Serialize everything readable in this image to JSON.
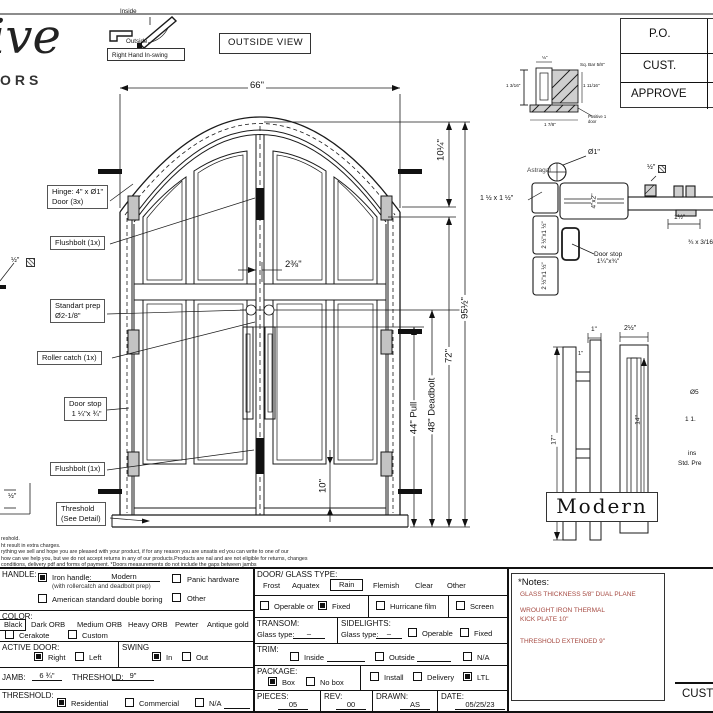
{
  "sheet": {
    "logo_script": "ive",
    "logo_sub": "ORS",
    "swing_icon": {
      "inside": "Inside",
      "outside": "Outside",
      "caption": "Right Hand In-swing"
    },
    "view_label": "OUTSIDE VIEW",
    "approval_rows": [
      "P.O.",
      "CUST.",
      "APPROVE"
    ],
    "cust_fragment": "CUST"
  },
  "elevation": {
    "dim_width": "66\"",
    "dim_arch": "10¼\"",
    "dim_height": "95½\"",
    "dim_leaf": "72\"",
    "dim_deadbolt": "48\" Deadbolt",
    "dim_pull": "44\" Pull",
    "dim_kick": "10\"",
    "dim_backset": "2⅜\"",
    "callouts": {
      "hinge_l1": "Hinge: 4\" x Ø1\"",
      "hinge_l2": "Door (3x)",
      "flushbolt_top": "Flushbolt (1x)",
      "prep_l1": "Standart prep",
      "prep_l2": "Ø2-1/8\"",
      "roller": "Roller catch  (1x)",
      "doorstop_l1": "Door stop",
      "doorstop_l2": "1 ¼\"x ¾\"",
      "flushbolt_bottom": "Flushbolt (1x)",
      "threshold_l1": "Threshold",
      "threshold_l2": "(See Detail)"
    },
    "left_fragments": {
      "half_dia": "½\"",
      "half_thr": "½\""
    }
  },
  "details": {
    "astragal": {
      "caption": "Astragal",
      "top": "⅛\"",
      "sq_bar": "Sq. Bar 5/8\"",
      "left": "1 3/16\"",
      "right": "1 11/16\"",
      "bottom": "1 7/8\"",
      "positive": "Positive 1 door"
    },
    "section": {
      "dia1": "Ø1\"",
      "tube_sq": "1 ½ x 1 ½\"",
      "tube_4x2": "4\"x2\"",
      "half_seal": "½\"",
      "tube_25a": "2 ½\"x1 ½\"",
      "tube_25b": "2 ½\"x1 ½\"",
      "doorstop_l1": "Door stop",
      "doorstop_l2": "1¼\"x¾\"",
      "dim_15": "1½\"",
      "frag_34": "¾ x 3/16\""
    },
    "pull": {
      "dim_1a": "1\"",
      "dim_1b": "1\"",
      "dim_17": "17\"",
      "dim_25": "2½\"",
      "dim_14": "14\"",
      "frag1": "Ø5",
      "frag2": "1 1.",
      "frag3": "ins",
      "frag4": "Std. Pre"
    },
    "style_label": "Modern"
  },
  "fine_print": {
    "lines": [
      "reshold.",
      "ht result in extra charges.",
      "rything we sell and hope you are pleased with your product, if for any reason you are unsatis   ed you can write to one of our",
      "how can we help you, but we do not accept returns in any of our products.Products are    nal and are not eligible for returns, changes",
      "conditions, delivery pdf and forms of payment. *Doors measurements do not include the gaps between jambs"
    ]
  },
  "form": {
    "handle": {
      "label": "HANDLE:",
      "iron": "Iron handle:",
      "iron_value": "Modern",
      "iron_note": "(with rollercatch and deadbolt prep)",
      "american": "American standard double boring",
      "panic": "Panic hardware",
      "other": "Other"
    },
    "color": {
      "label": "COLOR:",
      "selected": "Black",
      "options": [
        "Dark ORB",
        "Medium ORB",
        "Heavy ORB",
        "Pewter",
        "Antique gold"
      ],
      "cerakote": "Cerakote",
      "custom": "Custom"
    },
    "active_door": {
      "label": "ACTIVE DOOR:",
      "right": "Right",
      "left": "Left"
    },
    "swing": {
      "label": "SWING",
      "in": "In",
      "out": "Out"
    },
    "jamb": {
      "label": "JAMB:",
      "value": "6 ¾\"",
      "threshold_label": "THRESHOLD:",
      "threshold_value": "9\""
    },
    "threshold": {
      "label": "THRESHOLD:",
      "residential": "Residential",
      "commercial": "Commercial",
      "na": "N/A"
    },
    "glass": {
      "label": "DOOR/ GLASS TYPE:",
      "options": [
        "Frost",
        "Aquatex",
        "Rain",
        "Flemish",
        "Clear",
        "Other"
      ],
      "operable": "Operable  or",
      "fixed": "Fixed",
      "hurricane": "Hurricane film",
      "screen": "Screen"
    },
    "transom": {
      "label": "TRANSOM:",
      "glass_type": "Glass type:",
      "value": "–"
    },
    "sidelights": {
      "label": "SIDELIGHTS:",
      "glass_type": "Glass type:",
      "value": "–",
      "operable": "Operable",
      "fixed": "Fixed"
    },
    "trim": {
      "label": "TRIM:",
      "inside": "Inside",
      "outside": "Outside",
      "na": "N/A"
    },
    "package": {
      "label": "PACKAGE:",
      "box": "Box",
      "no_box": "No box",
      "install": "Install",
      "delivery": "Delivery",
      "ltl": "LTL"
    },
    "meta": {
      "pieces_label": "PIECES:",
      "pieces": "05",
      "rev_label": "REV:",
      "rev": "00",
      "drawn_label": "DRAWN:",
      "drawn": "AS",
      "date_label": "DATE:",
      "date": "05/25/23"
    }
  },
  "notes": {
    "title": "*Notes:",
    "line1": "GLASS THICKNESS 5/8\" DUAL PLANE",
    "line2": "WROUGHT IRON THERMAL",
    "line3": "KICK PLATE 10\"",
    "line4": "THRESHOLD EXTENDED 9\"",
    "accent_color": "#a64a42"
  }
}
